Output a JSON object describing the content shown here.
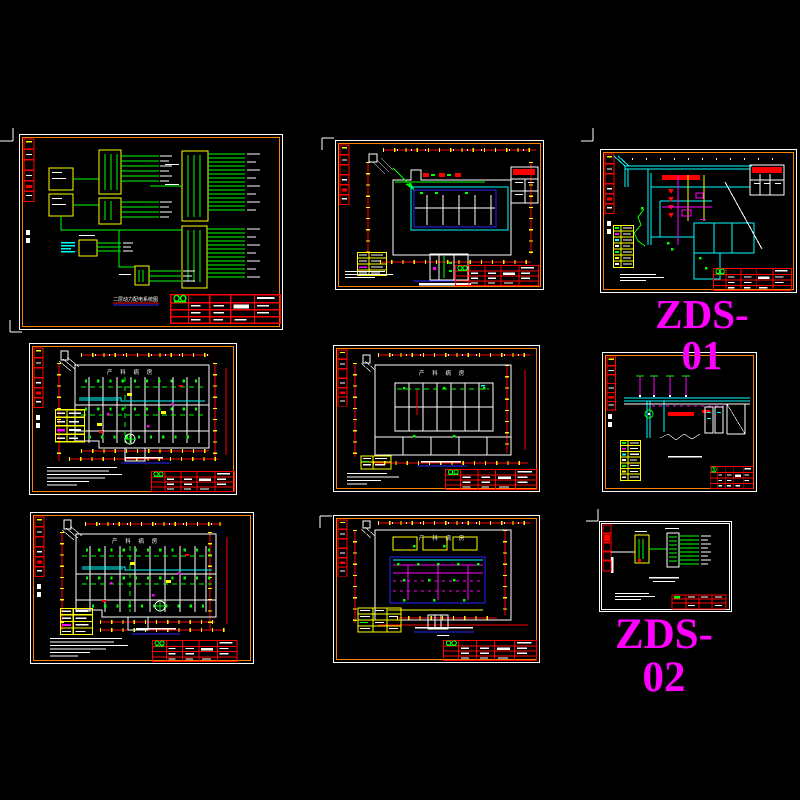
{
  "canvas": {
    "width": 800,
    "height": 800,
    "background": "#000000"
  },
  "palette": {
    "frame_white": "#ffffff",
    "border_orange": "#ff8000",
    "dimension_red": "#ff0000",
    "wiring_green": "#00ff00",
    "duct_cyan": "#00ffff",
    "circuit_magenta": "#ff00ff",
    "highlight_yellow": "#ffff00",
    "underline_blue": "#2424ff",
    "group_label_magenta": "#ff00ff"
  },
  "labels": {
    "zds01": "ZDS-01",
    "zds02": "ZDS-02"
  },
  "common": {
    "ward_header": "产 科 病 房"
  },
  "sheets": {
    "sys1": {
      "caption": "二层动力配电系统图"
    },
    "plan1": {},
    "zds01_plan": {},
    "ward1": {},
    "plan2": {},
    "section": {},
    "ward2": {},
    "plan3": {},
    "sys2": {}
  }
}
